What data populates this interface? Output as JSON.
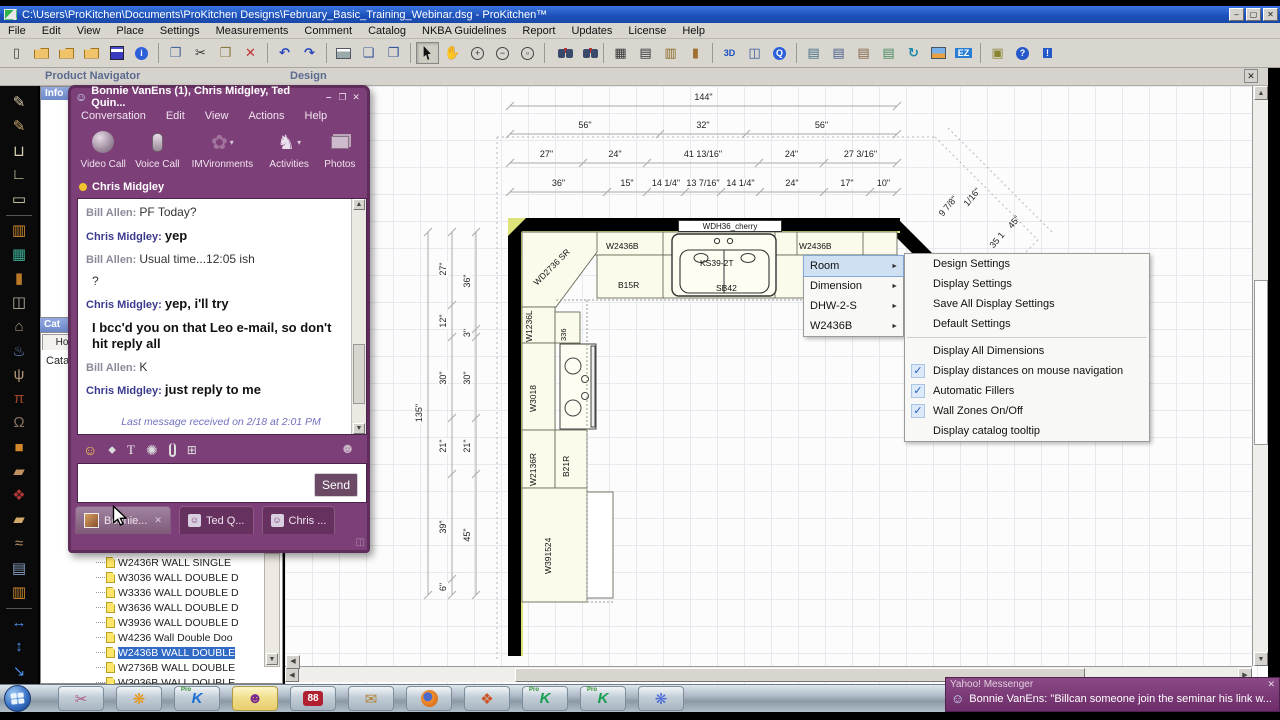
{
  "window": {
    "title": "C:\\Users\\ProKitchen\\Documents\\ProKitchen Designs\\February_Basic_Training_Webinar.dsg - ProKitchen™",
    "controls": [
      "‒",
      "▢",
      "✕"
    ]
  },
  "menu_bar": {
    "items": [
      "File",
      "Edit",
      "View",
      "Place",
      "Settings",
      "Measurements",
      "Comment",
      "Catalog",
      "NKBA Guidelines",
      "Report",
      "Updates",
      "License",
      "Help"
    ]
  },
  "toolbar": {
    "icons": [
      "new-file",
      "open",
      "import-design",
      "export-design",
      "save",
      "about",
      "|",
      "copy",
      "cut",
      "paste",
      "delete",
      "|",
      "undo",
      "redo",
      "|",
      "print",
      "print-preview",
      "page-setup",
      "|",
      "select-pointer",
      "pan-hand",
      "zoom-in",
      "zoom-out",
      "zoom-window",
      "|",
      "find",
      "find-replace",
      "|",
      "grid-toggle",
      "floor-plan-view",
      "elevation-view",
      "wall-view",
      "|",
      "view-3d",
      "panorama-view",
      "quicktime-view",
      "|",
      "report-settings",
      "customer-info",
      "copy-design",
      "catalog-docs",
      "sync-catalogs",
      "render-image",
      "ez-quote",
      "|",
      "tip-light",
      "manual",
      "help-run"
    ]
  },
  "tool_palette": {
    "icons": [
      "draw-wall",
      "draw-wall-arc",
      "wall-shape-u",
      "wall-shape-l",
      "room-rectangle",
      "|",
      "place-cabinet",
      "place-window",
      "place-door",
      "place-tall-cabinet",
      "place-hood",
      "place-plumbing",
      "place-lighting",
      "place-table",
      "place-decor",
      "place-box",
      "place-molding",
      "floor-covering",
      "place-counter",
      "place-valance",
      "item-report",
      "elevation-cabinets",
      "|",
      "dimension-horizontal",
      "dimension-vertical",
      "scale-design"
    ]
  },
  "dock": {
    "product_navigator_title": "Product Navigator",
    "info_header": "Info",
    "design_title": "Design",
    "design_close": "✕",
    "catalog_header": "Cat",
    "catalog_tab": "Home",
    "catalog_label": "Cata",
    "catalog_items": [
      {
        "label": "W2436R WALL SINGLE"
      },
      {
        "label": "W3036 WALL DOUBLE D"
      },
      {
        "label": "W3336 WALL DOUBLE D"
      },
      {
        "label": "W3636 WALL DOUBLE D"
      },
      {
        "label": "W3936 WALL DOUBLE D"
      },
      {
        "label": "W4236 Wall Double Doo"
      },
      {
        "label": "W2436B WALL DOUBLE",
        "selected": true
      },
      {
        "label": "W2736B WALL DOUBLE"
      },
      {
        "label": "W3036B WALL DOUBLE"
      }
    ]
  },
  "plan": {
    "top_dim_rows": [
      [
        "144\""
      ],
      [
        "56\"",
        "32\"",
        "56\""
      ],
      [
        "27\"",
        "24\"",
        "41 13/16\"",
        "24\"",
        "27 3/16\""
      ],
      [
        "36\"",
        "15\"",
        "14 1/4\"",
        "13 7/16\"",
        "14 1/4\"",
        "24\"",
        "17\"",
        "10\""
      ]
    ],
    "left_dim_col_a": [
      "27\"",
      "12\"",
      "30\"",
      "21\"",
      "39\"",
      "6\""
    ],
    "left_dim_col_b": [
      "36\"",
      "3\"",
      "30\"",
      "21\"",
      "45\""
    ],
    "overall_height": "135\"",
    "diagonal_dims": [
      "9 7/8\"",
      "1/16\"",
      "45\"",
      "35 1"
    ],
    "labels": {
      "wdh36": "WDH36_cherry",
      "corner": "WD2736 SR",
      "wall_left": "W2436B",
      "sink": "KS39-2T",
      "sink_base": "SB42",
      "wall_right": "W2436B",
      "base_b15": "B15R",
      "w1236l": "W1236L",
      "n336": "336",
      "w3018": "W3018",
      "w2136r": "W2136R",
      "b21r": "B21R",
      "w391524": "W391524"
    }
  },
  "context_menu": {
    "items": [
      {
        "label": "Room",
        "highlighted": true
      },
      {
        "label": "Dimension"
      },
      {
        "label": "DHW-2-S"
      },
      {
        "label": "W2436B"
      }
    ]
  },
  "settings_menu": {
    "items": [
      {
        "label": "Design Settings"
      },
      {
        "label": "Display Settings"
      },
      {
        "label": "Save All Display Settings"
      },
      {
        "label": "Default Settings"
      },
      {
        "separator": true
      },
      {
        "label": "Display All Dimensions"
      },
      {
        "label": "Display distances on mouse navigation",
        "checked": true
      },
      {
        "label": "Automatic Fillers",
        "checked": true
      },
      {
        "label": "Wall Zones On/Off",
        "checked": true
      },
      {
        "label": "Display catalog tooltip"
      }
    ]
  },
  "chat": {
    "title": "Bonnie VanEns (1), Chris Midgley, Ted Quin...",
    "controls": [
      "‒",
      "❐",
      "✕"
    ],
    "menu": [
      "Conversation",
      "Edit",
      "View",
      "Actions",
      "Help"
    ],
    "toolbar": [
      {
        "name": "video-call",
        "label": "Video Call"
      },
      {
        "name": "voice-call",
        "label": "Voice Call"
      },
      {
        "name": "imvironments",
        "label": "IMVironments"
      },
      {
        "name": "activities",
        "label": "Activities"
      },
      {
        "name": "photos",
        "label": "Photos"
      }
    ],
    "status_name": "Chris Midgley",
    "messages": [
      {
        "who": "bill",
        "sender": "Bill Allen:",
        "text": "PF Today?"
      },
      {
        "who": "chris",
        "sender": "Chris Midgley:",
        "text": "yep",
        "bold": true
      },
      {
        "who": "bill",
        "sender": "Bill Allen:",
        "text": "Usual time...12:05 ish"
      },
      {
        "who": "bill",
        "text": "?"
      },
      {
        "who": "chris",
        "sender": "Chris Midgley:",
        "text": "yep, i'll try",
        "bold": true
      },
      {
        "who": "chris",
        "text": "I bcc'd you on that Leo e-mail, so don't hit reply all",
        "bold": true
      },
      {
        "who": "bill",
        "sender": "Bill Allen:",
        "text": "K"
      },
      {
        "who": "chris",
        "sender": "Chris Midgley:",
        "text": "just reply to me",
        "bold": true
      }
    ],
    "footer": "Last message received on 2/18 at 2:01 PM",
    "send_label": "Send",
    "tabs": [
      {
        "label": "Bonnie...",
        "close": "✕",
        "active": true
      },
      {
        "label": "Ted Q..."
      },
      {
        "label": "Chris ..."
      }
    ]
  },
  "taskbar": {
    "buttons": [
      {
        "name": "snipping-tool"
      },
      {
        "name": "app-flower-orange"
      },
      {
        "name": "prokitchen-main",
        "badge": "Pro",
        "letter": "K"
      },
      {
        "name": "yahoo-messenger",
        "active": true
      },
      {
        "name": "app-88",
        "text": "88"
      },
      {
        "name": "mail"
      },
      {
        "name": "firefox"
      },
      {
        "name": "media-gallery"
      },
      {
        "name": "prokitchen-2",
        "badge": "Pro",
        "letter": "K"
      },
      {
        "name": "prokitchen-3",
        "badge": "Pro",
        "letter": "K"
      },
      {
        "name": "app-flower-blue"
      }
    ]
  },
  "notification": {
    "title": "Yahoo! Messenger",
    "close": "✕",
    "text": "Bonnie VanEns:  \"Billcan someone join the seminar his link w..."
  },
  "colors": {
    "titlebar_blue": "#1c50b8",
    "chat_purple": "#7d3f78",
    "selection_blue": "#316ac5",
    "cabinet_fill": "#fbfbec",
    "wall_accent": "#dde37a"
  }
}
